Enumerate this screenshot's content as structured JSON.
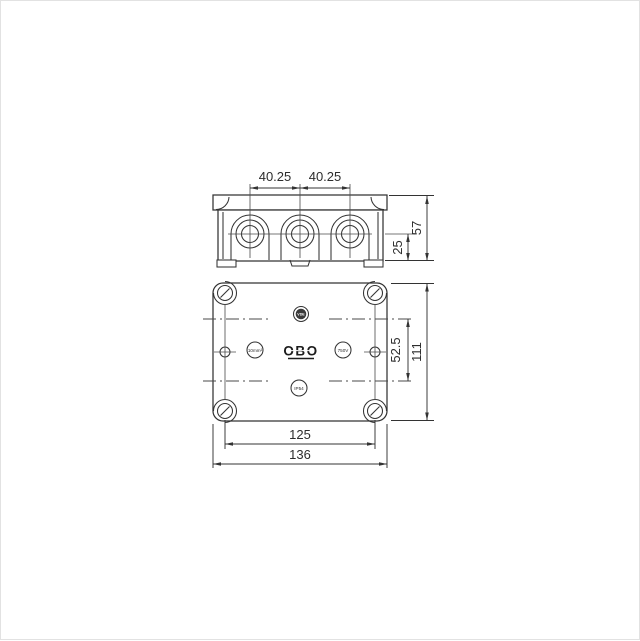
{
  "drawing": {
    "top_view": {
      "dim_spacing_left": "40.25",
      "dim_spacing_right": "40.25",
      "dim_height": "57",
      "dim_center_to_bottom": "25"
    },
    "front_view": {
      "logo": "OBO",
      "cert_mark": "VDE",
      "mark_left": "10mm²",
      "mark_right": "750V",
      "mark_bottom": "IP54",
      "dim_inner_height": "52.5",
      "dim_height": "111",
      "dim_screw_spacing": "125",
      "dim_width": "136"
    }
  },
  "colors": {
    "line": "#333333",
    "thin_line": "#4a4a4a",
    "dim_line": "#333333",
    "background": "#ffffff"
  }
}
